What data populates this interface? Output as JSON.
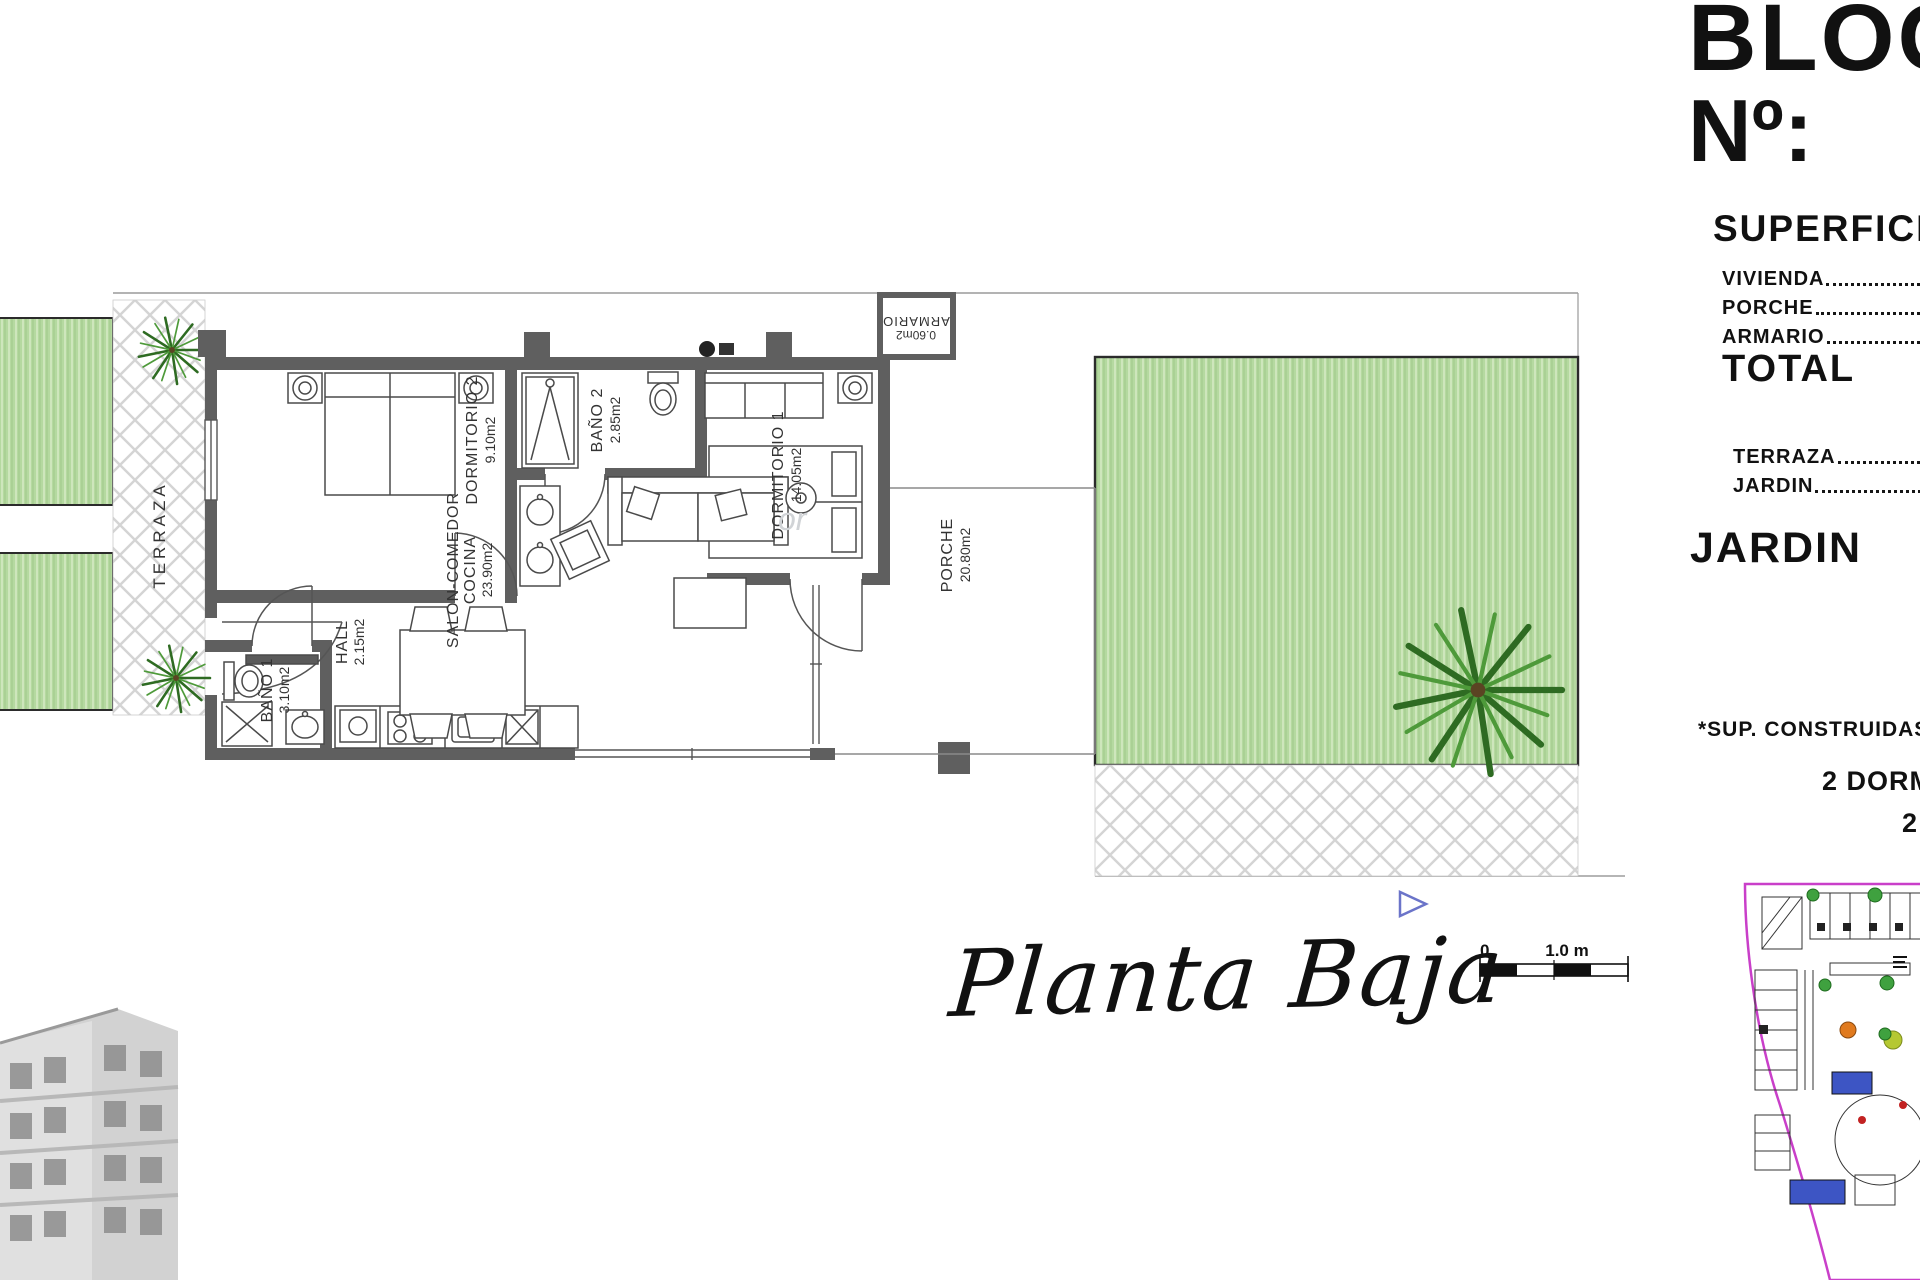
{
  "header": {
    "block_label": "BLOQ",
    "number_label": "Nº:",
    "number_value": "2"
  },
  "surfaces": {
    "heading": "SUPERFICIES",
    "rows": [
      {
        "label": "VIVIENDA"
      },
      {
        "label": "PORCHE"
      },
      {
        "label": "ARMARIO"
      }
    ],
    "total": {
      "label": "TOTAL",
      "separator": "_",
      "value": "8"
    },
    "outdoor_rows": [
      {
        "label": "TERRAZA"
      },
      {
        "label": "JARDIN"
      }
    ],
    "jardin_total": {
      "label": "JARDIN",
      "separator": "_",
      "value": "3"
    },
    "footnote": "*SUP. CONSTRUIDAS",
    "footnote_line2": "2 DORM",
    "footnote_line3": "2"
  },
  "plan": {
    "caption": "Planta Baja",
    "watermark": "or",
    "rooms": {
      "terraza": {
        "name": "TERRAZA"
      },
      "dormitorio2": {
        "name": "DORMITORIO 2",
        "area": "9.10m2"
      },
      "bano2": {
        "name": "BAÑO 2",
        "area": "2.85m2"
      },
      "dormitorio1": {
        "name": "DORMITORIO 1",
        "area": "14.05m2"
      },
      "armario": {
        "name": "ARMARIO",
        "area": "0.60m2"
      },
      "hall": {
        "name": "HALL",
        "area": "2.15m2"
      },
      "bano1": {
        "name": "BAÑO 1",
        "area": "3.10m2"
      },
      "salon": {
        "name": "SALON-COMEDOR",
        "name2": "COCINA",
        "area": "23.90m2"
      },
      "porche": {
        "name": "PORCHE",
        "area": "20.80m2"
      }
    }
  },
  "scale_bar": {
    "zero": "0",
    "one": "1.0 m"
  },
  "colors": {
    "wall": "#5f5f5f",
    "garden": "#b5d9a0",
    "map_border": "#c93fc9"
  }
}
